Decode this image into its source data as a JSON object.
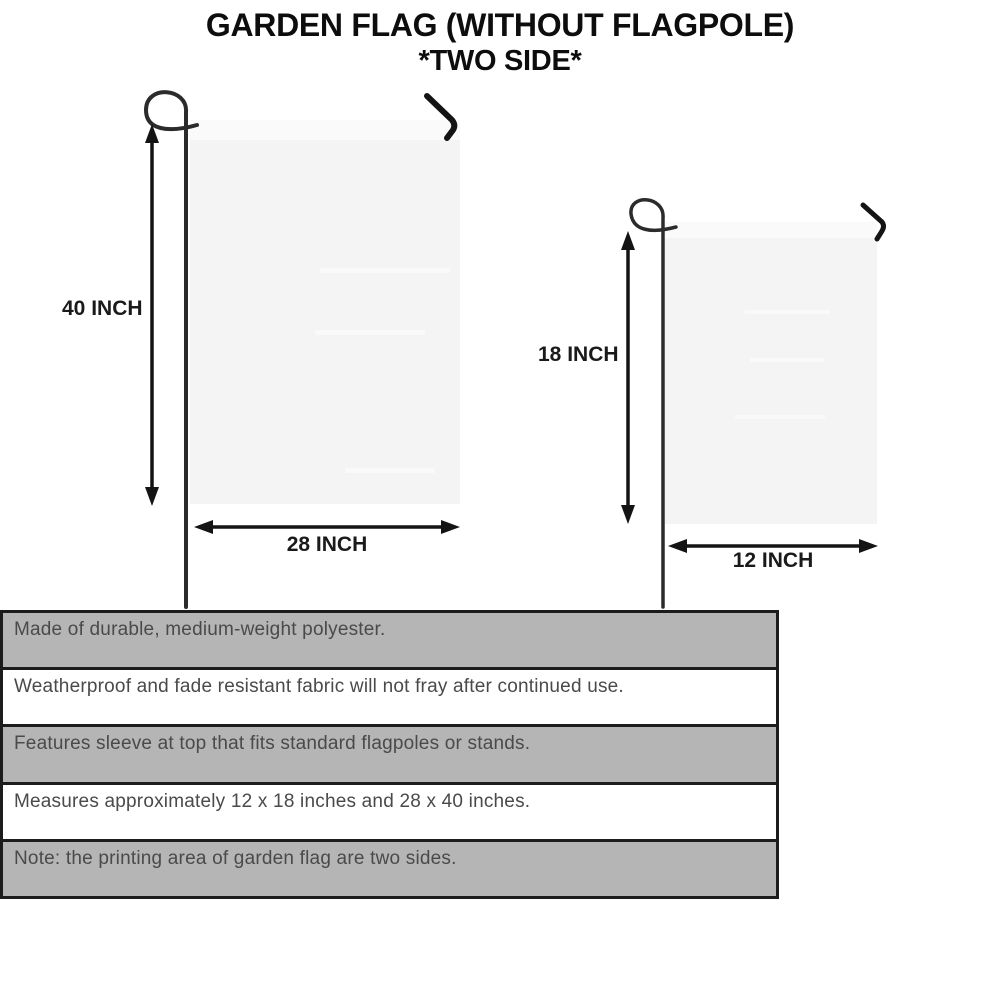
{
  "title": {
    "line1": "GARDEN FLAG (WITHOUT FLAGPOLE)",
    "line2": "*TWO SIDE*"
  },
  "flags": {
    "large": {
      "height_label": "40 INCH",
      "width_label": "28 INCH"
    },
    "small": {
      "height_label": "18 INCH",
      "width_label": "12 INCH"
    }
  },
  "features": [
    {
      "text": "Made of durable, medium-weight polyester."
    },
    {
      "text": "Weatherproof and fade resistant fabric will not fray after continued use."
    },
    {
      "text": "Features sleeve at top that fits standard flagpoles or stands."
    },
    {
      "text": "Measures approximately 12 x 18 inches and 28 x 40 inches."
    },
    {
      "text": "Note: the printing area of garden flag are two sides."
    }
  ],
  "colors": {
    "row_shaded": "#b5b5b5",
    "row_plain": "#ffffff",
    "table_border": "#1c1c1c",
    "flag_fill": "#f4f4f5",
    "flag_sleeve": "#fbfbfb",
    "ink": "#141414",
    "pole": "#2b2b2b",
    "feature_text": "#4a4a4a",
    "title_color": "#0d0d0d"
  }
}
